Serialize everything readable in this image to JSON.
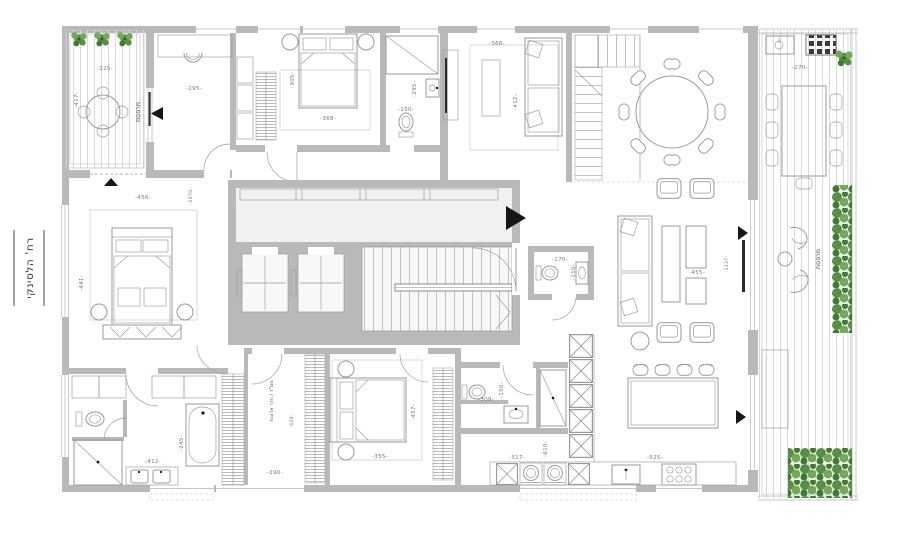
{
  "title": "apartment-floor-plan",
  "street": {
    "label": "רח' הלסינקי"
  },
  "labels": {
    "balcony_left": "מרפסת",
    "terrace_right": "מרפסת",
    "closet_room": "ממ\"ד / חדר ארונות",
    "d225": "-225-",
    "d417": "-417-",
    "d295_study": "-295-",
    "d305": "-305-",
    "d368": "-368-",
    "d295_bath": "-295-",
    "d150_bath": "-150-",
    "d366": "-366-",
    "d412_lounge": "-412-",
    "d270": "-270-",
    "d456": "-456-",
    "d1070": "-1070-",
    "d441": "-441-",
    "d455": "-455-",
    "d1237": "-1237-",
    "d170": "-170-",
    "d110": "-110-",
    "d429": "-429-",
    "d290": "-290-",
    "d412_bath": "-412-",
    "d245": "-245-",
    "d355": "-355-",
    "d457": "-457-",
    "d309": "-309-",
    "d150_wc": "-150-",
    "d610": "-610-",
    "d317": "-317-",
    "d525": "-525-"
  },
  "colors": {
    "wall": "#b9b9b9",
    "line": "#9a9a9a",
    "dimc": "#787878",
    "deckline": "#d8d8d6",
    "p1": "#569141",
    "p2": "#72aa58",
    "p3": "#3f7a33",
    "mark": "#161616"
  }
}
